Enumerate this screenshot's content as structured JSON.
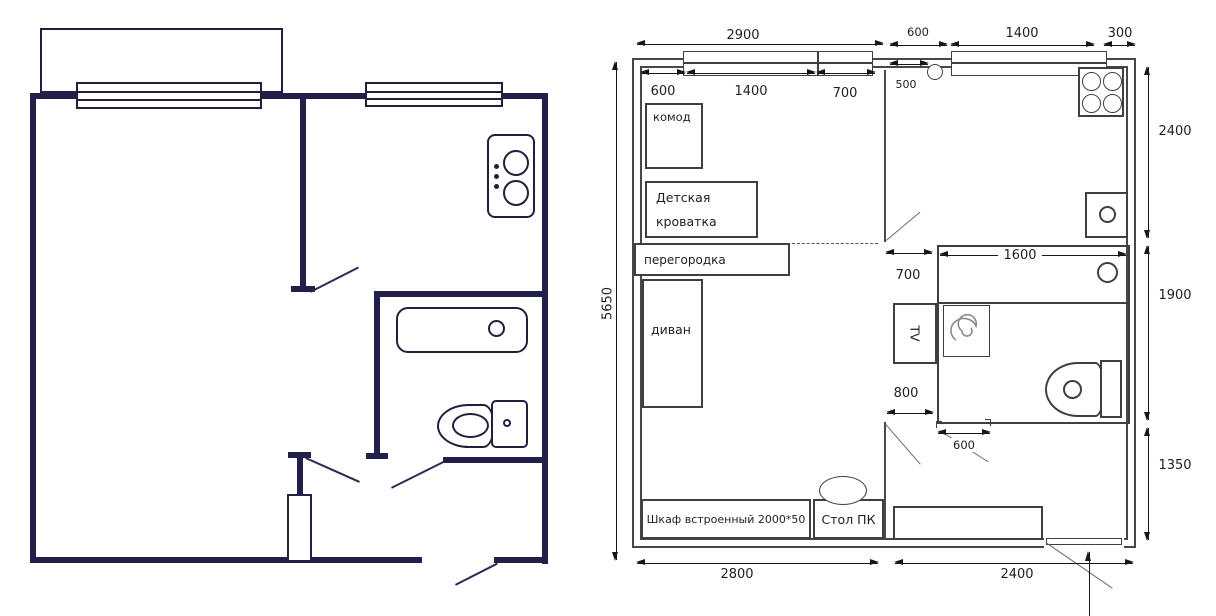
{
  "right_plan": {
    "furniture": {
      "komod": "комод",
      "crib_l1": "Детская",
      "crib_l2": "кроватка",
      "partition": "перегородка",
      "sofa": "диван",
      "wardrobe": "Шкаф встроенный 2000*50",
      "desk": "Стол ПК",
      "tv": "TV"
    },
    "dims": {
      "top_total": "2900",
      "top_seg1": "600",
      "top_seg2": "1400",
      "top_seg3": "700",
      "kitchen_seg1": "600",
      "kitchen_seg2": "1400",
      "kitchen_seg3": "300",
      "riser": "500",
      "height_total": "5650",
      "kitchen_depth": "2400",
      "bath_depth": "1900",
      "hall_depth": "1350",
      "passage_top": "700",
      "bath_width": "1600",
      "passage_bottom": "800",
      "bath_door": "600",
      "room_width": "2800",
      "hall_width": "2400"
    }
  },
  "colors": {
    "left_plan_wall": "#20204a",
    "right_plan_line": "#3f3f3f",
    "dimension_line": "#161616",
    "background": "#ffffff"
  }
}
